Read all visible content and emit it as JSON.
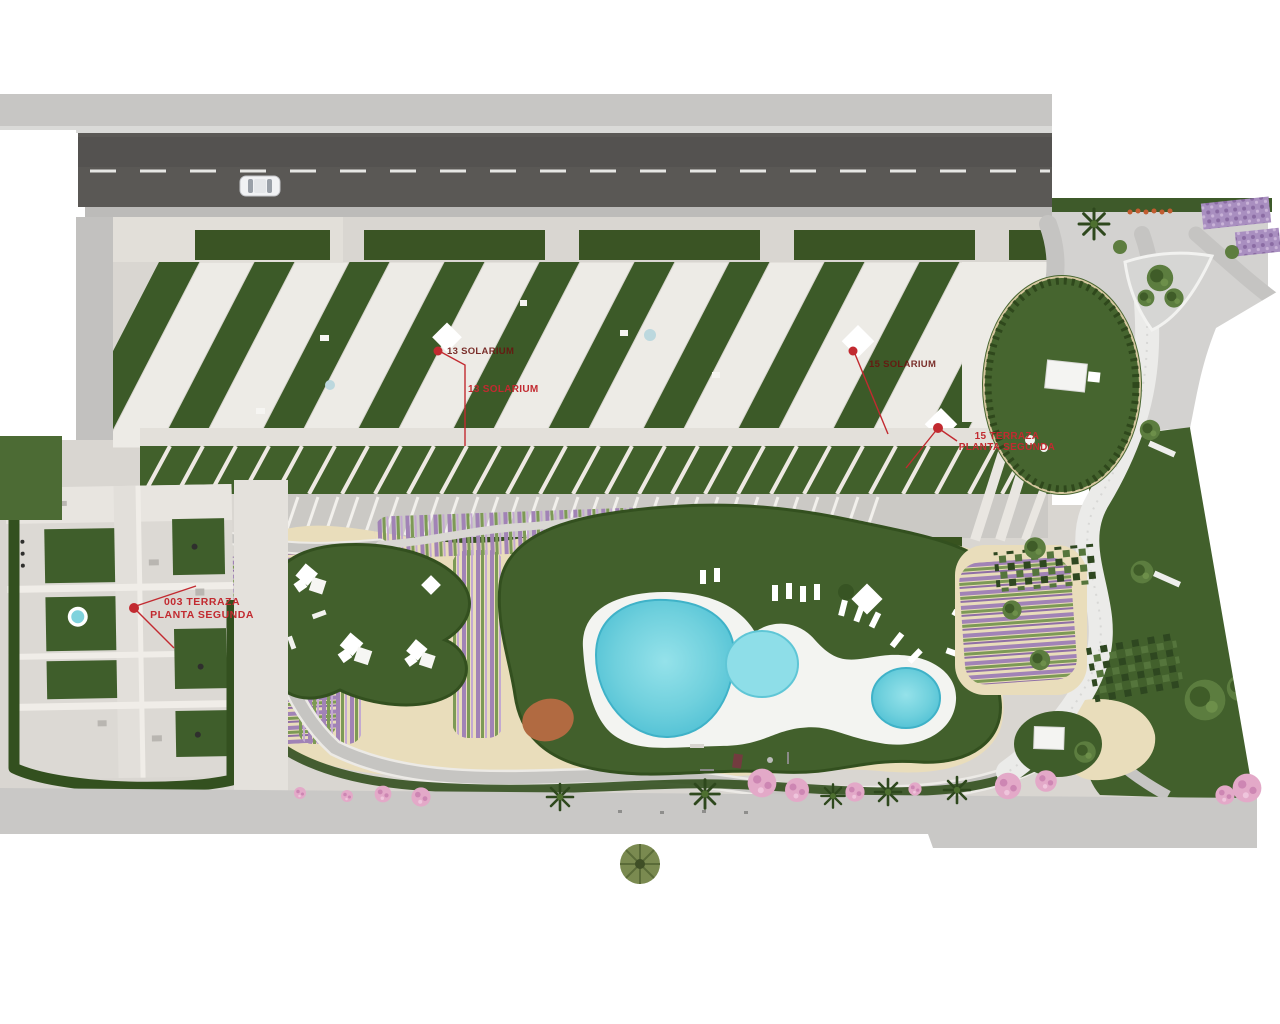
{
  "scene": {
    "type": "aerial-site-plan-render"
  },
  "colors": {
    "background": "#ffffff",
    "asphalt_road": "#5a5855",
    "sidewalk": "#c7c6c4",
    "paving": "#d9d6d1",
    "grass_dark": "#3d5827",
    "grass_lawn": "#46652f",
    "hedge": "#33501f",
    "sand": "#e9ddbb",
    "pool_water": "#4fc0d4",
    "pool_water_light": "#8edee8",
    "pool_deck": "#f3f4f1",
    "lavender": "#a183b6",
    "blossom_pink": "#e3a9c8",
    "terracotta": "#b16a41",
    "annotation_red": "#c22a30",
    "annotation_dark_red": "#6a130f",
    "car_body": "#f1f2f4"
  },
  "icons": {
    "car": "car-top-view-icon",
    "palm": "palm-tree-icon",
    "round_tree": "round-tree-icon",
    "blossom_tree": "blossom-tree-icon",
    "marker_dot": "red-marker-dot-icon"
  },
  "annotations": {
    "solarium_13_tag": {
      "text": "13 SOLARIUM"
    },
    "solarium_13": {
      "text": "13 SOLARIUM"
    },
    "solarium_15_tag": {
      "text": "15 SOLARIUM"
    },
    "terraza_15": {
      "line1": "15  TERRAZA",
      "line2": "PLANTA SEGUNDA"
    },
    "terraza_003": {
      "line1": "003 TERRAZA",
      "line2": "PLANTA SEGUNDA"
    }
  }
}
